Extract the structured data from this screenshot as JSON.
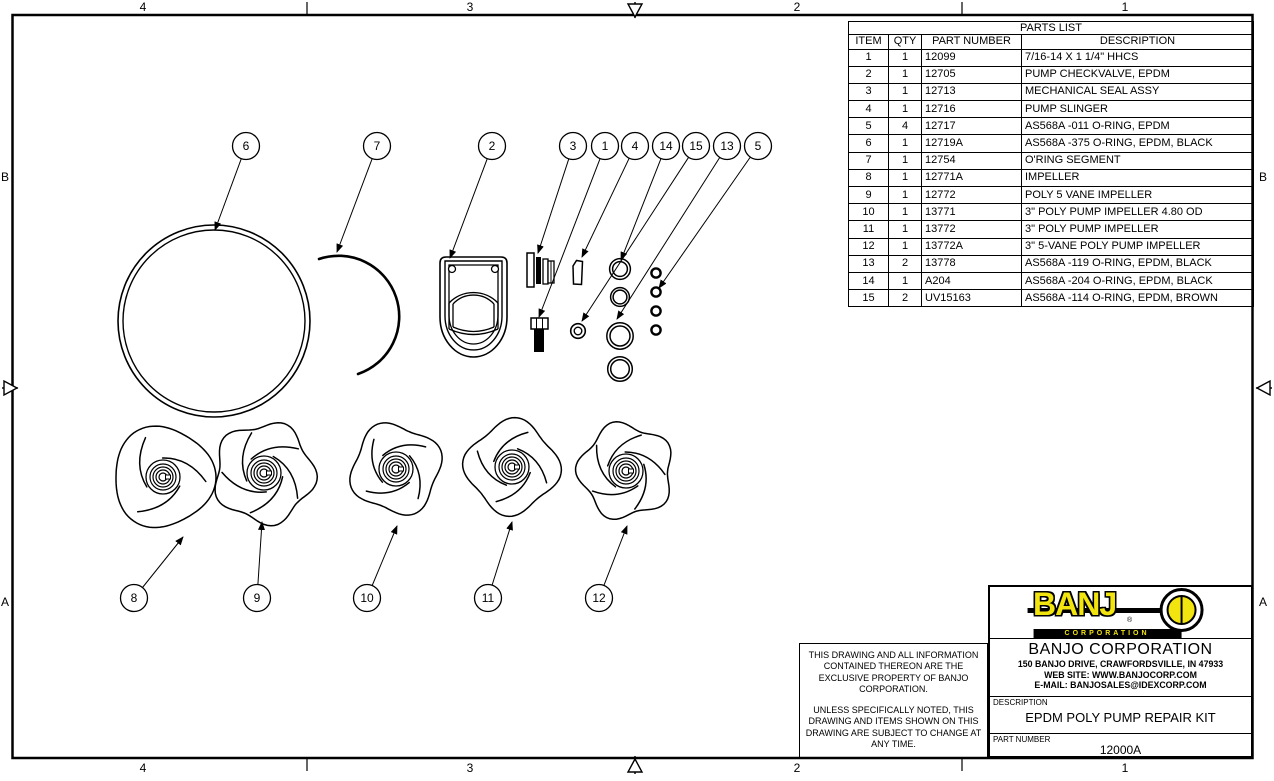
{
  "sheet": {
    "zone_labels_top": [
      "4",
      "3",
      "2",
      "1"
    ],
    "zone_labels_bottom": [
      "4",
      "3",
      "2",
      "1"
    ],
    "zone_labels_left": [
      "B",
      "A"
    ],
    "zone_labels_right": [
      "B",
      "A"
    ]
  },
  "parts_list": {
    "title": "PARTS LIST",
    "columns": [
      "ITEM",
      "QTY",
      "PART NUMBER",
      "DESCRIPTION"
    ],
    "rows": [
      {
        "item": "1",
        "qty": "1",
        "part_number": "12099",
        "description": "7/16-14 X 1 1/4\" HHCS"
      },
      {
        "item": "2",
        "qty": "1",
        "part_number": "12705",
        "description": "PUMP CHECKVALVE, EPDM"
      },
      {
        "item": "3",
        "qty": "1",
        "part_number": "12713",
        "description": "MECHANICAL SEAL ASSY"
      },
      {
        "item": "4",
        "qty": "1",
        "part_number": "12716",
        "description": "PUMP SLINGER"
      },
      {
        "item": "5",
        "qty": "4",
        "part_number": "12717",
        "description": "AS568A -011 O-RING, EPDM"
      },
      {
        "item": "6",
        "qty": "1",
        "part_number": "12719A",
        "description": "AS568A -375 O-RING, EPDM, BLACK"
      },
      {
        "item": "7",
        "qty": "1",
        "part_number": "12754",
        "description": "O'RING SEGMENT"
      },
      {
        "item": "8",
        "qty": "1",
        "part_number": "12771A",
        "description": "IMPELLER"
      },
      {
        "item": "9",
        "qty": "1",
        "part_number": "12772",
        "description": "POLY 5 VANE IMPELLER"
      },
      {
        "item": "10",
        "qty": "1",
        "part_number": "13771",
        "description": "3\" POLY PUMP IMPELLER 4.80 OD"
      },
      {
        "item": "11",
        "qty": "1",
        "part_number": "13772",
        "description": "3\" POLY PUMP IMPELLER"
      },
      {
        "item": "12",
        "qty": "1",
        "part_number": "13772A",
        "description": "3\" 5-VANE POLY PUMP IMPELLER"
      },
      {
        "item": "13",
        "qty": "2",
        "part_number": "13778",
        "description": "AS568A -119 O-RING, EPDM, BLACK"
      },
      {
        "item": "14",
        "qty": "1",
        "part_number": "A204",
        "description": "AS568A -204 O-RING, EPDM, BLACK"
      },
      {
        "item": "15",
        "qty": "2",
        "part_number": "UV15163",
        "description": "AS568A -114 O-RING, EPDM, BROWN"
      }
    ]
  },
  "callouts": [
    "6",
    "7",
    "2",
    "3",
    "1",
    "4",
    "14",
    "15",
    "13",
    "5",
    "8",
    "9",
    "10",
    "11",
    "12"
  ],
  "disclaimer": {
    "para1": "THIS DRAWING AND ALL INFORMATION CONTAINED THEREON ARE THE EXCLUSIVE PROPERTY OF BANJO CORPORATION.",
    "para2": "UNLESS SPECIFICALLY NOTED, THIS DRAWING AND ITEMS SHOWN ON THIS DRAWING ARE SUBJECT TO CHANGE AT ANY TIME."
  },
  "title_block": {
    "logo_word": "BANJ",
    "logo_reg": "®",
    "logo_sub": "CORPORATION",
    "company_name": "BANJO CORPORATION",
    "address": "150 BANJO DRIVE, CRAWFORDSVILLE, IN 47933",
    "website": "WEB SITE: WWW.BANJOCORP.COM",
    "email": "E-MAIL: BANJOSALES@IDEXCORP.COM",
    "description_label": "DESCRIPTION",
    "description": "EPDM POLY PUMP REPAIR KIT",
    "part_number_label": "PART NUMBER",
    "part_number": "12000A"
  },
  "colors": {
    "banjo_yellow": "#f2e40e",
    "line": "#000000",
    "background": "#ffffff"
  }
}
